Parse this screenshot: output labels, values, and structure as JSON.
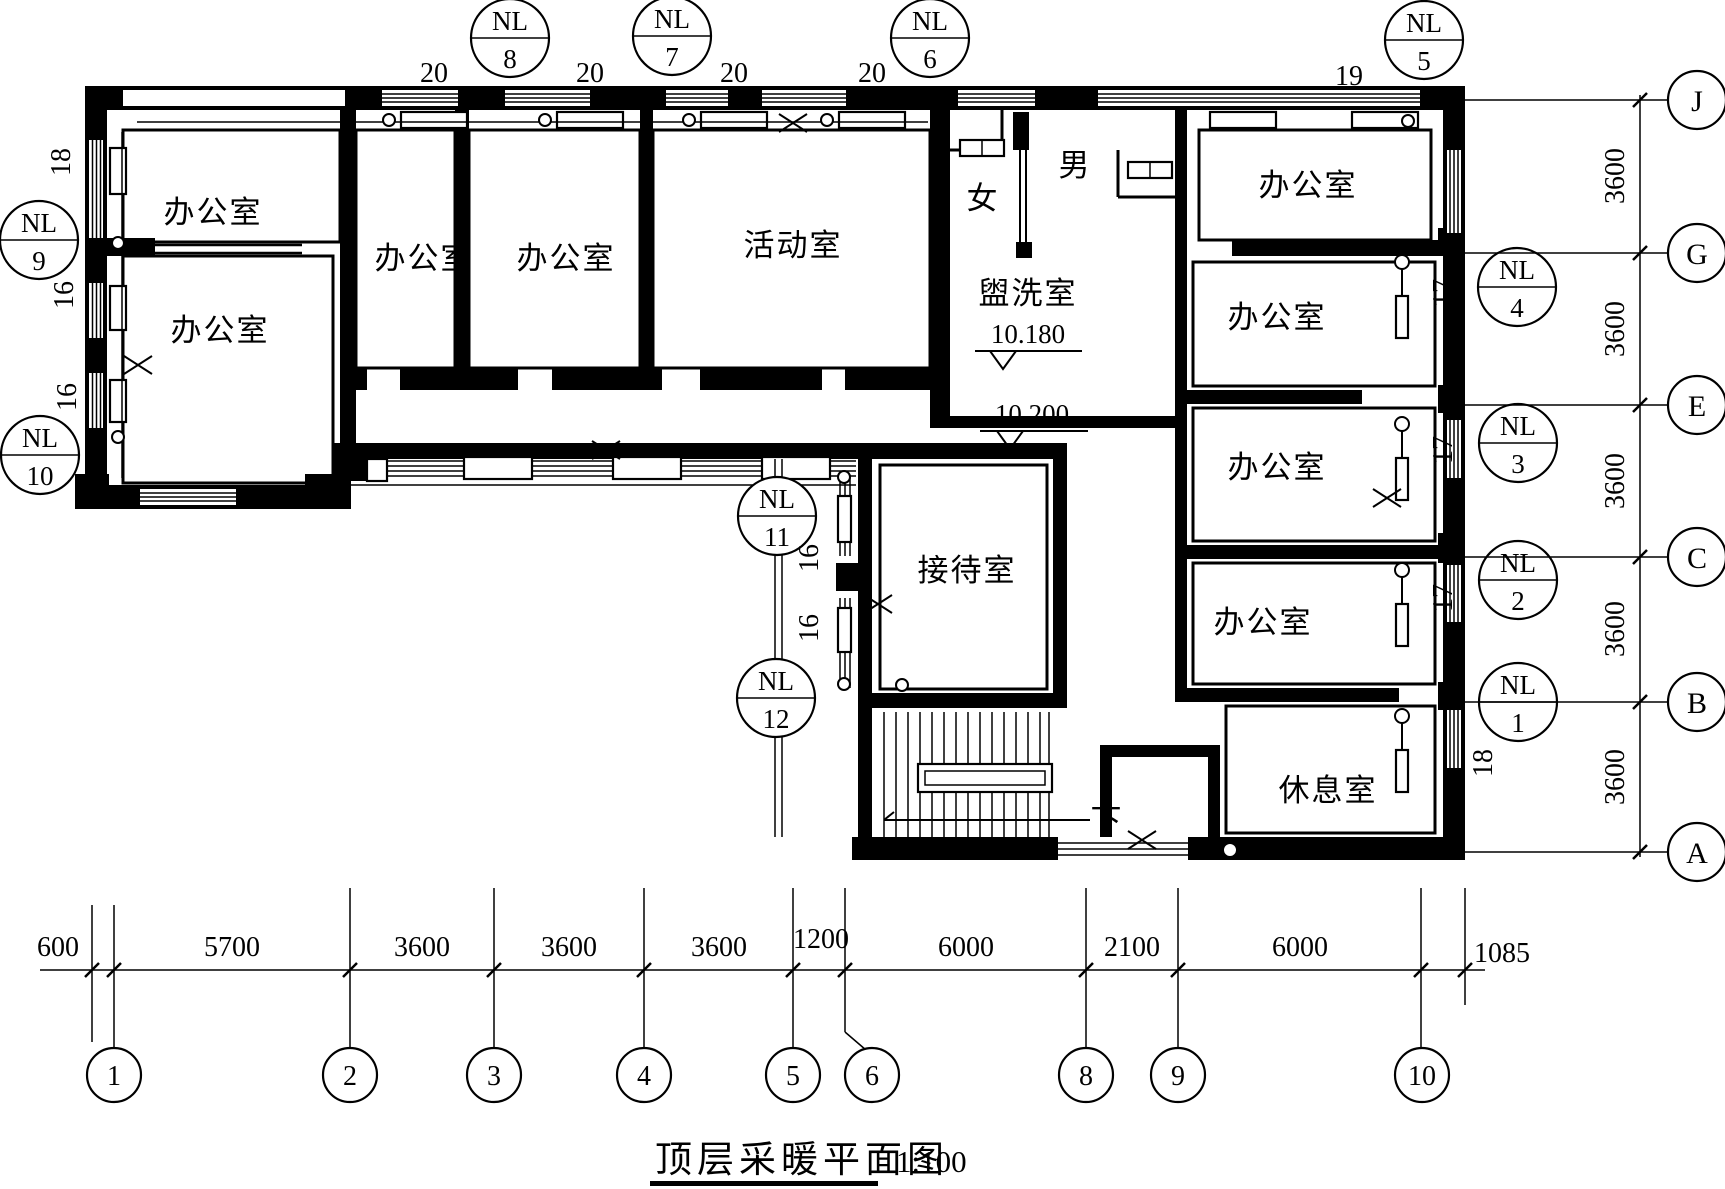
{
  "title": {
    "text": "顶层采暖平面图",
    "scale": "1:100"
  },
  "rooms": {
    "office": "办公室",
    "activity": "活动室",
    "washroom": "盥洗室",
    "reception": "接待室",
    "lounge": "休息室",
    "male": "男",
    "female": "女",
    "down": "下"
  },
  "elevations": {
    "washroom_level": "10.180",
    "corridor_level": "10.200"
  },
  "riser": {
    "label": "NL",
    "top": [
      "8",
      "7",
      "6",
      "5"
    ],
    "left": [
      "9",
      "10"
    ],
    "middle": [
      "11",
      "12"
    ],
    "right": [
      "4",
      "3",
      "2",
      "1"
    ]
  },
  "pipes": {
    "top": [
      "20",
      "20",
      "20",
      "20",
      "19"
    ],
    "left": [
      "18",
      "16",
      "16"
    ],
    "middle": [
      "16",
      "16"
    ],
    "right": [
      "17",
      "17",
      "17",
      "18"
    ]
  },
  "axes": {
    "rows": [
      "J",
      "G",
      "E",
      "C",
      "B",
      "A"
    ],
    "cols": [
      "1",
      "2",
      "3",
      "4",
      "5",
      "6",
      "8",
      "9",
      "10"
    ],
    "row_dims": [
      "3600",
      "3600",
      "3600",
      "3600",
      "3600"
    ],
    "col_dims": [
      "600",
      "5700",
      "3600",
      "3600",
      "3600",
      "1200",
      "6000",
      "2100",
      "6000",
      "1085"
    ]
  }
}
